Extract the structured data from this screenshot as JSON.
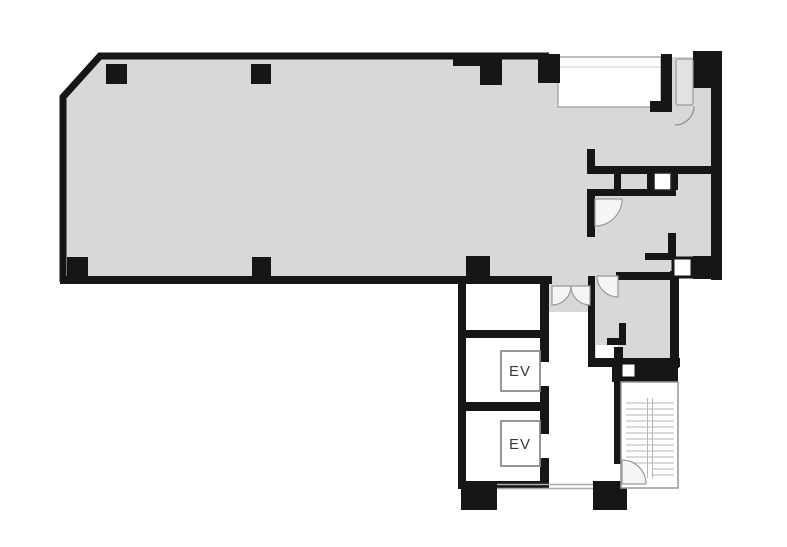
{
  "floorplan": {
    "type": "building-floor-plan",
    "labels": {
      "elevator_1": "EV",
      "elevator_2": "EV"
    },
    "colors": {
      "background": "#ffffff",
      "wall": "#161616",
      "floor_fill": "#d8d8d8",
      "thin_line": "#aaaaaa",
      "door_arc": "#9a9a9a",
      "stair_tread": "#b5b5b5"
    },
    "elements": [
      "main-room",
      "balcony-recess",
      "washroom-stalls",
      "service-shaft",
      "corridor-double-door",
      "elevator-hall",
      "elevator-shaft-1",
      "elevator-shaft-2",
      "stairwell",
      "structural-columns",
      "door-swings"
    ]
  }
}
